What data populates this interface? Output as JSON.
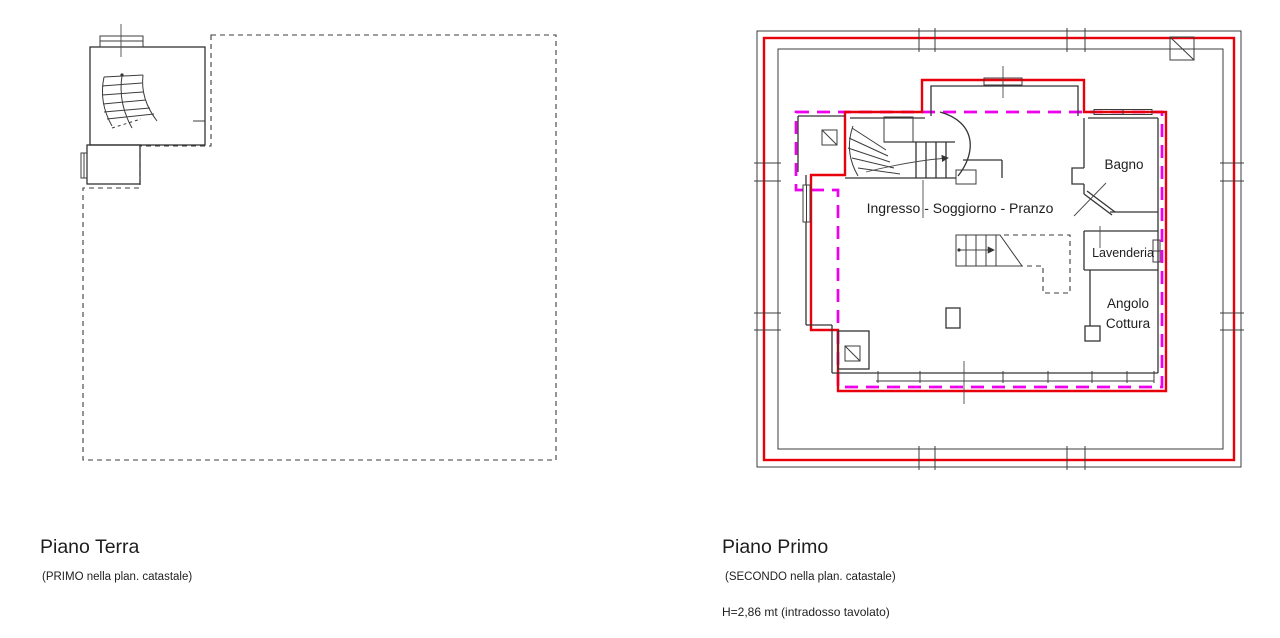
{
  "colors": {
    "red": "#e8000a",
    "magenta": "#ee00ee",
    "line": "#3c3c3c"
  },
  "left_plan": {
    "title": "Piano Terra",
    "subtitle": "(PRIMO nella plan. catastale)"
  },
  "right_plan": {
    "title": "Piano Primo",
    "subtitle": "(SECONDO nella plan. catastale)",
    "height_note": "H=2,86 mt (intradosso tavolato)",
    "rooms": {
      "main": "Ingresso - Soggiorno - Pranzo",
      "bathroom": "Bagno",
      "laundry": "Lavenderia",
      "kitchen_line1": "Angolo",
      "kitchen_line2": "Cottura"
    }
  }
}
